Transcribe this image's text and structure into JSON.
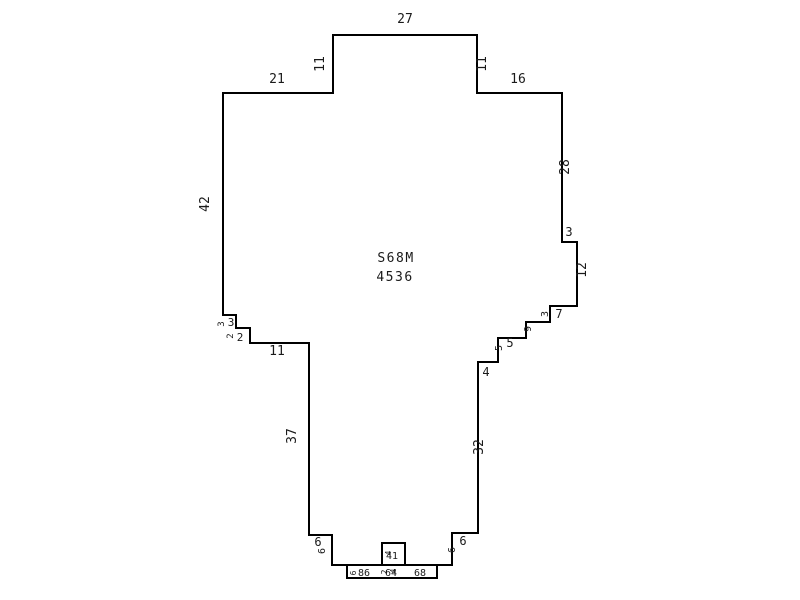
{
  "diagram": {
    "type": "parcel-sketch",
    "background_color": "#ffffff",
    "line_color": "#000000",
    "text_color": "#1a1a1a",
    "center_label": {
      "line1": "S68M",
      "line2": "4536"
    },
    "polygon_points": [
      [
        223,
        93
      ],
      [
        333,
        93
      ],
      [
        333,
        35
      ],
      [
        477,
        35
      ],
      [
        477,
        93
      ],
      [
        562,
        93
      ],
      [
        562,
        242
      ],
      [
        577,
        242
      ],
      [
        577,
        306
      ],
      [
        550,
        306
      ],
      [
        550,
        322
      ],
      [
        526,
        322
      ],
      [
        526,
        338
      ],
      [
        498,
        338
      ],
      [
        498,
        362
      ],
      [
        478,
        362
      ],
      [
        478,
        533
      ],
      [
        452,
        533
      ],
      [
        452,
        565
      ],
      [
        332,
        565
      ],
      [
        332,
        535
      ],
      [
        309,
        535
      ],
      [
        309,
        343
      ],
      [
        250,
        343
      ],
      [
        250,
        328
      ],
      [
        236,
        328
      ],
      [
        236,
        315
      ],
      [
        223,
        315
      ]
    ],
    "attached_rects": [
      {
        "name": "bottom-strip",
        "x": 347,
        "y": 565,
        "w": 90,
        "h": 13
      },
      {
        "name": "notch-box",
        "x": 382,
        "y": 543,
        "w": 23,
        "h": 22
      }
    ],
    "dimension_labels": [
      {
        "text": "27",
        "x": 405,
        "y": 23,
        "rot": 0,
        "size": 13
      },
      {
        "text": "11",
        "x": 324,
        "y": 64,
        "rot": -90,
        "size": 13
      },
      {
        "text": "11",
        "x": 486,
        "y": 64,
        "rot": -90,
        "size": 13
      },
      {
        "text": "21",
        "x": 277,
        "y": 83,
        "rot": 0,
        "size": 13
      },
      {
        "text": "16",
        "x": 518,
        "y": 83,
        "rot": 0,
        "size": 13
      },
      {
        "text": "42",
        "x": 209,
        "y": 204,
        "rot": -90,
        "size": 13
      },
      {
        "text": "28",
        "x": 569,
        "y": 167,
        "rot": -90,
        "size": 13
      },
      {
        "text": "3",
        "x": 569,
        "y": 236,
        "rot": 0,
        "size": 12
      },
      {
        "text": "12",
        "x": 586,
        "y": 270,
        "rot": -90,
        "size": 13
      },
      {
        "text": "3",
        "x": 548,
        "y": 314,
        "rot": -90,
        "size": 10
      },
      {
        "text": "7",
        "x": 559,
        "y": 318,
        "rot": 0,
        "size": 12
      },
      {
        "text": "9",
        "x": 531,
        "y": 329,
        "rot": -90,
        "size": 10
      },
      {
        "text": "5",
        "x": 502,
        "y": 348,
        "rot": -90,
        "size": 10
      },
      {
        "text": "5",
        "x": 510,
        "y": 347,
        "rot": 0,
        "size": 12
      },
      {
        "text": "4",
        "x": 486,
        "y": 376,
        "rot": 0,
        "size": 12
      },
      {
        "text": "32",
        "x": 483,
        "y": 447,
        "rot": -90,
        "size": 13
      },
      {
        "text": "37",
        "x": 296,
        "y": 436,
        "rot": -90,
        "size": 13
      },
      {
        "text": "11",
        "x": 277,
        "y": 355,
        "rot": 0,
        "size": 13
      },
      {
        "text": "3",
        "x": 224,
        "y": 324,
        "rot": -90,
        "size": 9
      },
      {
        "text": "3",
        "x": 231,
        "y": 326,
        "rot": 0,
        "size": 11
      },
      {
        "text": "2",
        "x": 233,
        "y": 336,
        "rot": -90,
        "size": 9
      },
      {
        "text": "2",
        "x": 240,
        "y": 341,
        "rot": 0,
        "size": 11
      },
      {
        "text": "6",
        "x": 318,
        "y": 546,
        "rot": 0,
        "size": 12
      },
      {
        "text": "6",
        "x": 325,
        "y": 551,
        "rot": -90,
        "size": 10
      },
      {
        "text": "6",
        "x": 463,
        "y": 545,
        "rot": 0,
        "size": 12
      },
      {
        "text": "6",
        "x": 455,
        "y": 550,
        "rot": -90,
        "size": 10
      },
      {
        "text": "6",
        "x": 356,
        "y": 573,
        "rot": -90,
        "size": 8
      },
      {
        "text": "86",
        "x": 364,
        "y": 576,
        "rot": 0,
        "size": 10
      },
      {
        "text": "64",
        "x": 391,
        "y": 576,
        "rot": 0,
        "size": 10
      },
      {
        "text": "2",
        "x": 387,
        "y": 572,
        "rot": -90,
        "size": 8
      },
      {
        "text": "4",
        "x": 396,
        "y": 571,
        "rot": -90,
        "size": 8
      },
      {
        "text": "68",
        "x": 420,
        "y": 576,
        "rot": 0,
        "size": 10
      },
      {
        "text": "4",
        "x": 389,
        "y": 559,
        "rot": 0,
        "size": 10
      },
      {
        "text": "1",
        "x": 395,
        "y": 559,
        "rot": 0,
        "size": 10
      },
      {
        "text": "4",
        "x": 391,
        "y": 553,
        "rot": -90,
        "size": 8
      }
    ]
  }
}
